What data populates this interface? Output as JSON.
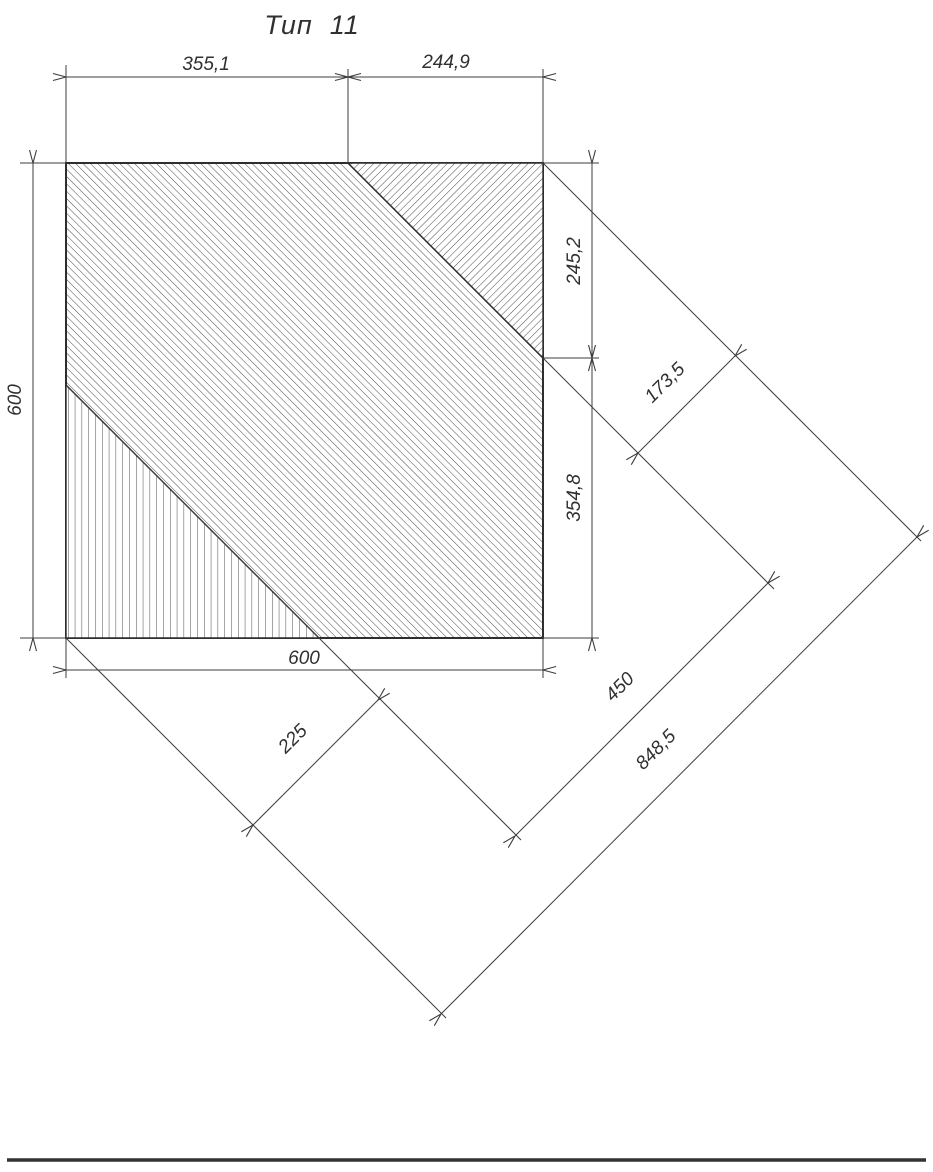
{
  "title": "Тип  11",
  "colors": {
    "outline": "#2e2e2e",
    "dimension_line": "#3d3d3d",
    "hatch": "#4a4a4a",
    "background": "#ffffff"
  },
  "panel": {
    "shape": "square",
    "width_label": "600",
    "height_label": "600",
    "regions": [
      {
        "name": "main-field",
        "hatch": "diagonal-backslash"
      },
      {
        "name": "top-right-triangle",
        "hatch": "diagonal-slash"
      },
      {
        "name": "bottom-left-triangle",
        "hatch": "vertical"
      }
    ]
  },
  "dimensions": {
    "top_left": "355,1",
    "top_right": "244,9",
    "left_height": "600",
    "right_upper": "245,2",
    "right_lower": "354,8",
    "bottom_width": "600",
    "diag_offset_small": "173,5",
    "diag_offset_lower": "225",
    "diag_offset_mid": "450",
    "diag_offset_total": "848,5"
  }
}
